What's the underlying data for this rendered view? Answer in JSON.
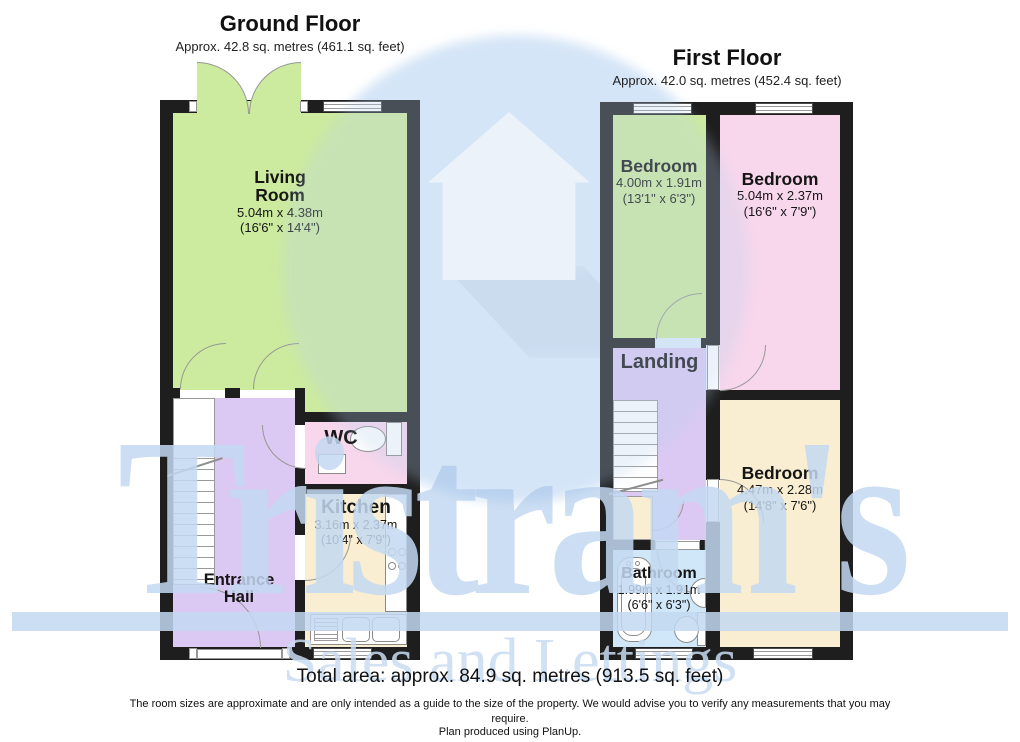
{
  "watermark": {
    "brand": "Tristram's",
    "tagline": "Sales and Lettings",
    "color": "#c3d8f1",
    "circle_color": "#e0edfb",
    "house_icon": "house-icon"
  },
  "colors": {
    "wall": "#1e1e1e",
    "room_green": "#cdeb9e",
    "room_pink": "#f8d7ec",
    "room_lavender": "#dcc9f3",
    "room_cream": "#f9eed1",
    "room_blue": "#cfe7f8"
  },
  "ground": {
    "title": "Ground Floor",
    "area": "Approx. 42.8 sq. metres (461.1 sq. feet)",
    "living": {
      "name": "Living\nRoom",
      "metric": "5.04m x 4.38m",
      "imperial": "(16'6\" x 14'4\")"
    },
    "wc": {
      "name": "WC"
    },
    "kitchen": {
      "name": "Kitchen",
      "metric": "3.16m x 2.37m",
      "imperial": "(10'4\" x 7'9\")"
    },
    "hall": {
      "name": "Entrance\nHall"
    }
  },
  "first": {
    "title": "First Floor",
    "area": "Approx. 42.0 sq. metres (452.4 sq. feet)",
    "bedroom1": {
      "name": "Bedroom",
      "metric": "4.00m x 1.91m",
      "imperial": "(13'1\" x 6'3\")"
    },
    "bedroom2": {
      "name": "Bedroom",
      "metric": "5.04m x 2.37m",
      "imperial": "(16'6\" x 7'9\")"
    },
    "landing": {
      "name": "Landing"
    },
    "bedroom3": {
      "name": "Bedroom",
      "metric": "4.47m x 2.28m",
      "imperial": "(14'8\" x 7'6\")"
    },
    "bathroom": {
      "name": "Bathroom",
      "metric": "1.99m x 1.91m",
      "imperial": "(6'6\" x 6'3\")"
    }
  },
  "footer": {
    "total": "Total area: approx. 84.9 sq. metres (913.5 sq. feet)",
    "disclaimer": "The room sizes are approximate and are only intended as a guide to the size of the property. We would advise you to verify any measurements that you may require.",
    "produced": "Plan produced using PlanUp."
  }
}
